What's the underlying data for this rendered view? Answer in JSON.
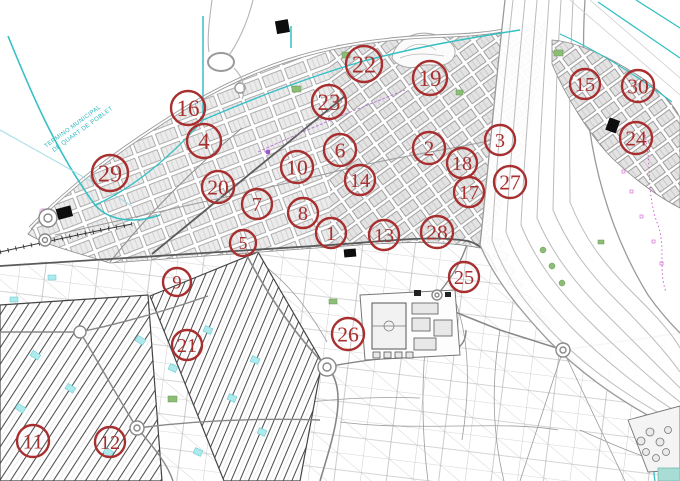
{
  "map": {
    "description": "Urban cadastral plan with numbered site markers",
    "boundary_label_line1": "TERMINO MUNICIPAL",
    "boundary_label_line2": "DE QUART DE POBLET",
    "marker_color": "#a82f2f",
    "water_color": "#35c0c4",
    "admin_boundary_color": "#cc55cc",
    "green_color": "#8cbd77",
    "marker_count": 30
  },
  "markers": [
    {
      "label": "1",
      "x": 331,
      "y": 233,
      "r": 15
    },
    {
      "label": "2",
      "x": 429,
      "y": 148,
      "r": 16
    },
    {
      "label": "3",
      "x": 500,
      "y": 140,
      "r": 15
    },
    {
      "label": "4",
      "x": 204,
      "y": 141,
      "r": 17
    },
    {
      "label": "5",
      "x": 243,
      "y": 243,
      "r": 13
    },
    {
      "label": "6",
      "x": 340,
      "y": 150,
      "r": 16
    },
    {
      "label": "7",
      "x": 257,
      "y": 204,
      "r": 15
    },
    {
      "label": "8",
      "x": 303,
      "y": 213,
      "r": 15
    },
    {
      "label": "9",
      "x": 177,
      "y": 282,
      "r": 14
    },
    {
      "label": "10",
      "x": 297,
      "y": 167,
      "r": 16
    },
    {
      "label": "11",
      "x": 33,
      "y": 441,
      "r": 16
    },
    {
      "label": "12",
      "x": 110,
      "y": 442,
      "r": 15
    },
    {
      "label": "13",
      "x": 384,
      "y": 235,
      "r": 15
    },
    {
      "label": "14",
      "x": 360,
      "y": 180,
      "r": 15
    },
    {
      "label": "15",
      "x": 585,
      "y": 84,
      "r": 15
    },
    {
      "label": "16",
      "x": 188,
      "y": 108,
      "r": 17
    },
    {
      "label": "17",
      "x": 469,
      "y": 192,
      "r": 15
    },
    {
      "label": "18",
      "x": 462,
      "y": 163,
      "r": 15
    },
    {
      "label": "19",
      "x": 430,
      "y": 78,
      "r": 17
    },
    {
      "label": "20",
      "x": 218,
      "y": 187,
      "r": 16
    },
    {
      "label": "21",
      "x": 187,
      "y": 345,
      "r": 15
    },
    {
      "label": "22",
      "x": 364,
      "y": 64,
      "r": 18
    },
    {
      "label": "23",
      "x": 329,
      "y": 102,
      "r": 17
    },
    {
      "label": "24",
      "x": 636,
      "y": 138,
      "r": 16
    },
    {
      "label": "25",
      "x": 464,
      "y": 277,
      "r": 15
    },
    {
      "label": "26",
      "x": 348,
      "y": 334,
      "r": 16
    },
    {
      "label": "27",
      "x": 510,
      "y": 182,
      "r": 16
    },
    {
      "label": "28",
      "x": 437,
      "y": 232,
      "r": 16
    },
    {
      "label": "29",
      "x": 110,
      "y": 173,
      "r": 18
    },
    {
      "label": "30",
      "x": 638,
      "y": 86,
      "r": 16
    }
  ]
}
